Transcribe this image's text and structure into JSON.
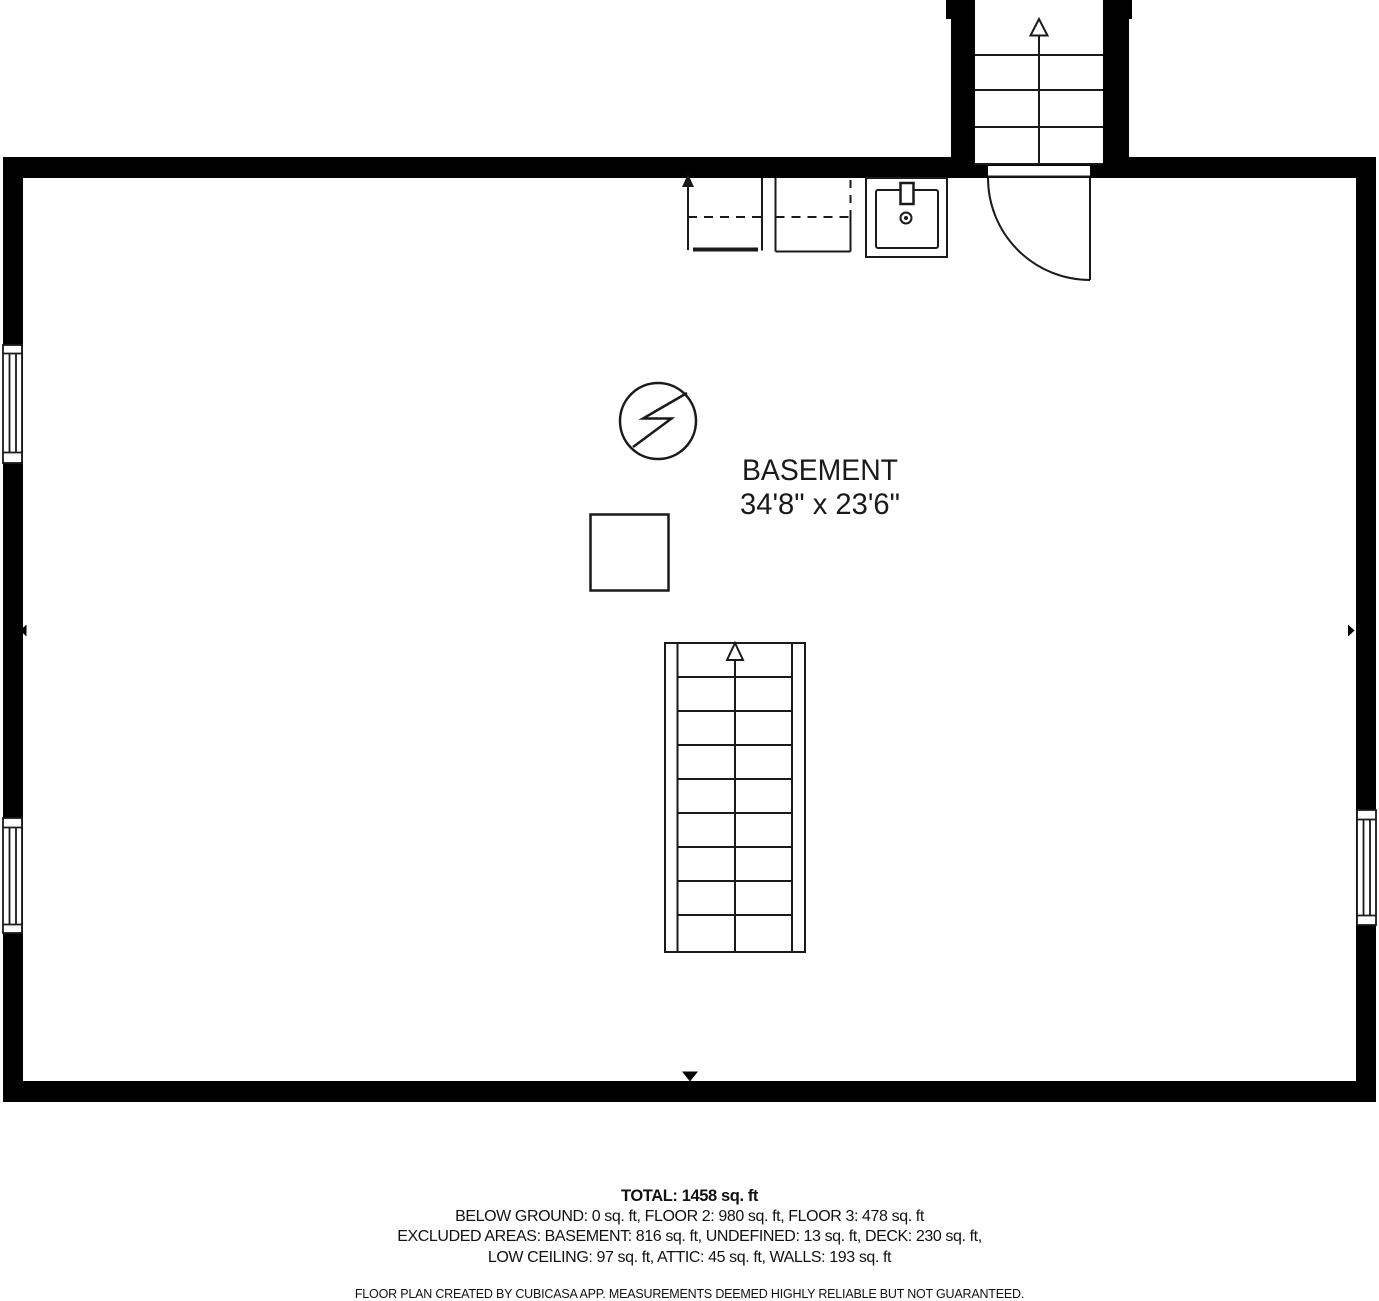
{
  "room": {
    "name": "BASEMENT",
    "dimensions": "34'8\" x 23'6\""
  },
  "summary": {
    "total": "TOTAL: 1458 sq. ft",
    "floors_line": "BELOW GROUND: 0 sq. ft, FLOOR 2: 980 sq. ft, FLOOR 3: 478 sq. ft",
    "excluded_line_1": "EXCLUDED AREAS: BASEMENT: 816 sq. ft, UNDEFINED: 13 sq. ft, DECK: 230 sq. ft,",
    "excluded_line_2": "LOW CEILING: 97 sq. ft, ATTIC: 45 sq. ft, WALLS: 193 sq. ft",
    "disclaimer": "FLOOR PLAN CREATED BY CUBICASA APP. MEASUREMENTS DEEMED HIGHLY RELIABLE BUT NOT GUARANTEED."
  },
  "colors": {
    "wall": "#000000",
    "line": "#1a1a1a",
    "background": "#ffffff"
  }
}
